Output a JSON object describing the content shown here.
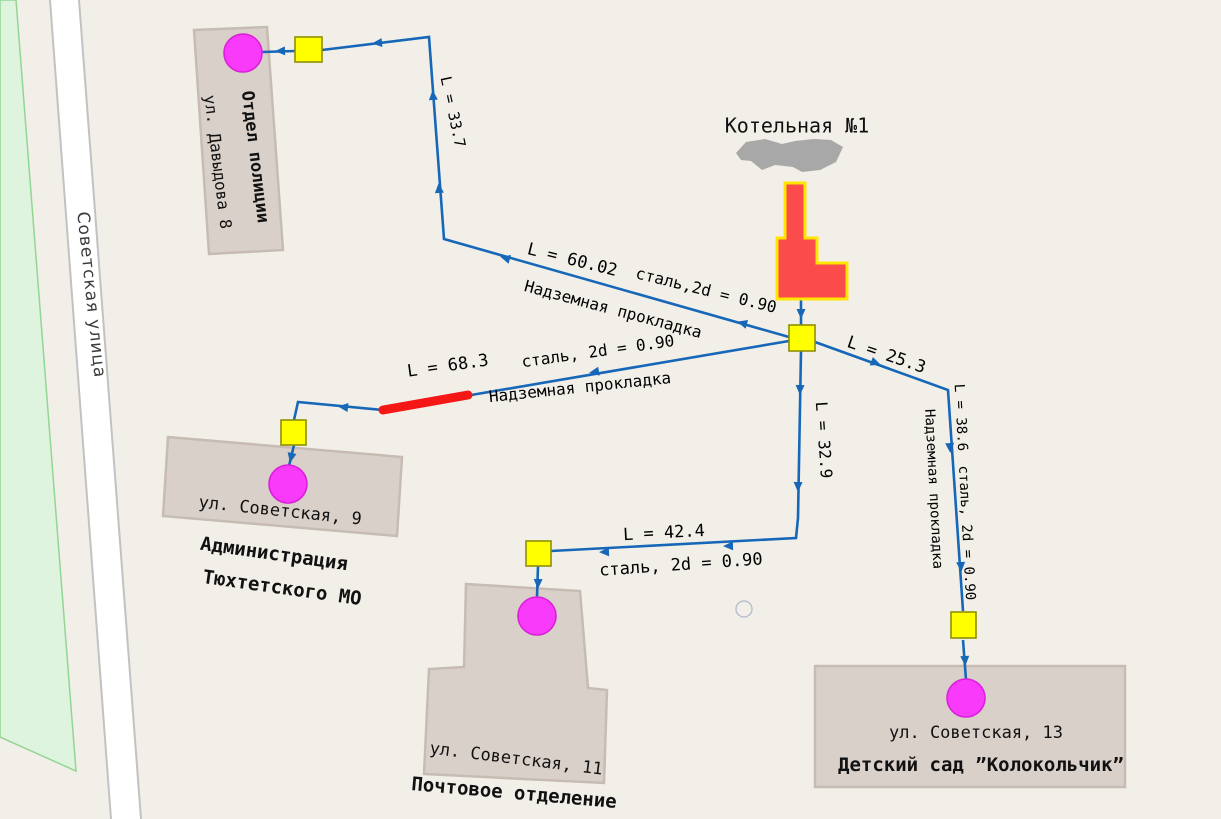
{
  "map": {
    "street": {
      "label": "Советская улица"
    }
  },
  "source": {
    "label": "Котельная №1"
  },
  "buildings": {
    "police": {
      "name": "Отдел полиции",
      "address": "ул. Давыдова 8"
    },
    "admin": {
      "address": "ул. Советская, 9",
      "name_line1": "Администрация",
      "name_line2": "Тюхтетского МО"
    },
    "post": {
      "address": "ул. Советская, 11",
      "name": "Почтовое отделение"
    },
    "kindergarten": {
      "address": "ул. Советская, 13",
      "name": "Детский сад ”Колокольчик”"
    }
  },
  "pipes": {
    "to_police": {
      "length": "L = 33.7"
    },
    "main_west": {
      "length": "L = 60.02",
      "spec": "сталь,2d = 0.90",
      "laying": "Надземная прокладка"
    },
    "to_admin": {
      "length": "L = 68.3",
      "spec": "сталь, 2d = 0.90",
      "laying": "Надземная прокладка"
    },
    "south": {
      "length": "L = 32.9"
    },
    "to_post": {
      "length": "L = 42.4",
      "spec": "сталь, 2d = 0.90"
    },
    "east": {
      "length": "L = 25.3"
    },
    "to_kindergarten": {
      "length": "L = 38.6",
      "spec": "сталь, 2d = 0.90",
      "laying": "Надземная прокладка"
    }
  },
  "colors": {
    "background": "#f2efe9",
    "pipe": "#1767b8",
    "pipe_disabled_segment": "#f51616",
    "node_fill": "#ffff00",
    "node_border": "#8f8f00",
    "consumer_fill": "#fa3afa",
    "consumer_border": "#d921d9",
    "source_fill": "#fb4b4b",
    "source_outline": "#ffe600",
    "smoke": "#a8a8a8",
    "building_fill": "#d9d0ca",
    "building_border": "#c7bcb4",
    "green_area_fill": "#dff4df",
    "green_area_border": "#93d593",
    "road_fill": "#ffffff",
    "road_border": "#c2c2c2"
  }
}
